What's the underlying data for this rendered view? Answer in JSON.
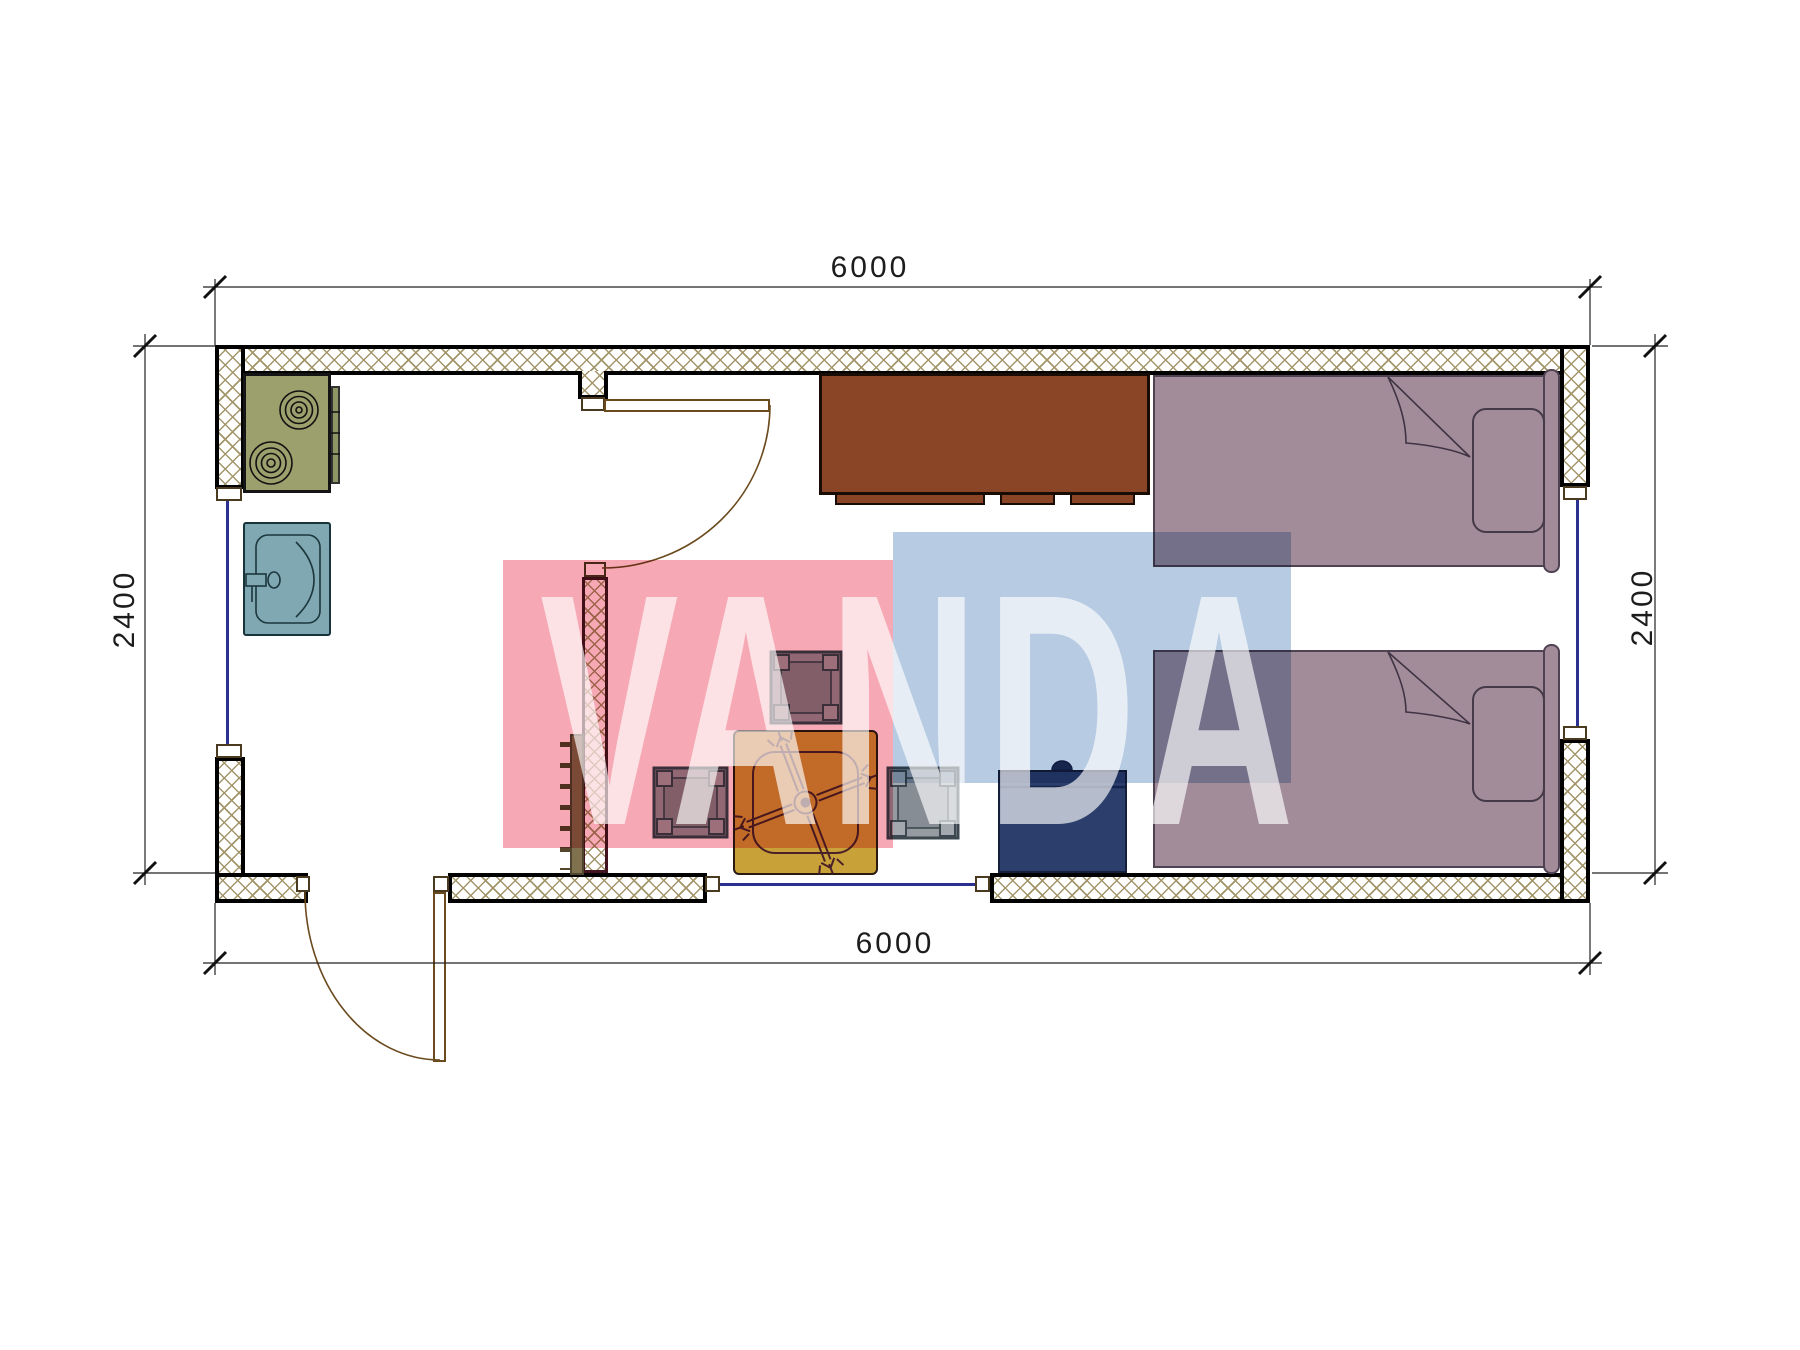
{
  "drawing": {
    "type": "floor-plan",
    "room": "container cabin with kitchen corner, dining set and two single beds",
    "background": "#ffffff"
  },
  "dimensions": {
    "top": "6000",
    "bottom": "6000",
    "left": "2400",
    "right": "2400"
  },
  "watermark": {
    "text": "VANDA",
    "pink": "#f6a9b4",
    "blue": "#b7cbe3",
    "text_color": "rgba(255,255,255,0.65)"
  },
  "palette": {
    "wall_hatch": "#a3966a",
    "wall_border": "#000000",
    "partition_border": "#421420",
    "window_line": "#2b3190",
    "door_line": "#6b4a1e",
    "stove": "#9ba06c",
    "sink": "#7fa8b2",
    "cabinet": "#8a4527",
    "bed": "#a28c9a",
    "bed_outline": "#4f4252",
    "table": "#c9a139",
    "stool": "#959ba1",
    "nightstand": "#2c3f6c",
    "radiator": "#7f704e",
    "dimension_line": "#222222"
  },
  "elements": [
    "stove-2-burners",
    "kitchen-sink",
    "wardrobe-cabinet",
    "single-bed-top",
    "single-bed-bottom",
    "pillow",
    "dining-table",
    "stool-top",
    "stool-left",
    "stool-right",
    "nightstand",
    "radiator",
    "entry-door",
    "interior-door",
    "window-left",
    "window-right",
    "window-bottom"
  ]
}
